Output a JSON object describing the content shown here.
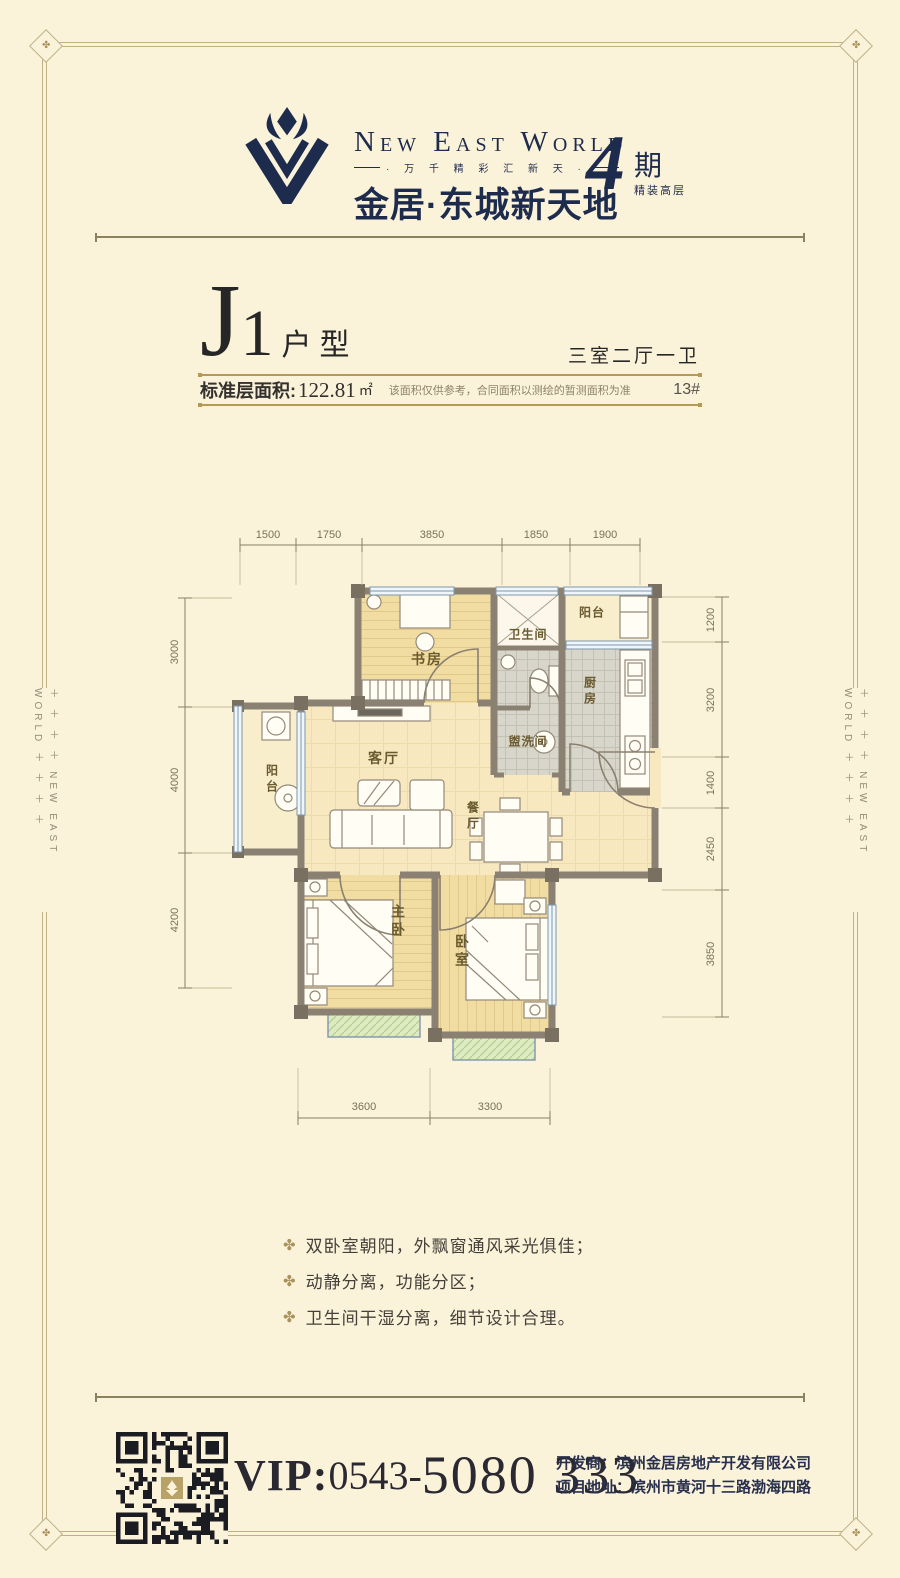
{
  "icons": {
    "corner_clover": "✤",
    "bullet": "✤"
  },
  "brand": {
    "name_en": "New East World",
    "tagline": "· 万 千 精 彩 汇 新 天 ·",
    "name_cn": "金居·东城新天地",
    "phase_number": "4",
    "phase_unit": "期",
    "phase_sub": "精装高层",
    "side_text": "＋ ＋ ＋ ＋  NEW EAST WORLD  ＋ ＋ ＋ ＋"
  },
  "unit": {
    "code_letter": "J",
    "code_digit": "1",
    "type_label": "户型",
    "layout": "三室二厅一卫",
    "area_label": "标准层面积:",
    "area_value": "122.81",
    "area_unit": "㎡",
    "area_note": "该面积仅供参考，合同面积以测绘的暂测面积为准",
    "building_no": "13#"
  },
  "floorplan": {
    "rooms": {
      "study": "书房",
      "bath": "卫生间",
      "wash": "盥洗间",
      "balcony_top": "阳台",
      "kitchen": "厨房",
      "living": "客厅",
      "balcony_left": "阳台",
      "dining": "餐厅",
      "master": "主卧",
      "bedroom": "卧室"
    },
    "dims": {
      "top": [
        "1500",
        "1750",
        "3850",
        "1850",
        "1900"
      ],
      "left": [
        "3000",
        "4000",
        "4200"
      ],
      "right": [
        "1200",
        "3200",
        "1400",
        "2450",
        "3850"
      ],
      "bottom": [
        "3600",
        "3300"
      ]
    }
  },
  "features": [
    "双卧室朝阳，外飘窗通风采光俱佳；",
    "动静分离，功能分区；",
    "卫生间干湿分离，细节设计合理。"
  ],
  "footer": {
    "vip_prefix": "VIP:",
    "vip_area": "0543-",
    "vip_number": "5080 333",
    "developer": "开发商：滨州金居房地产开发有限公司",
    "address": "项目地址：滨州市黄河十三路渤海四路"
  }
}
